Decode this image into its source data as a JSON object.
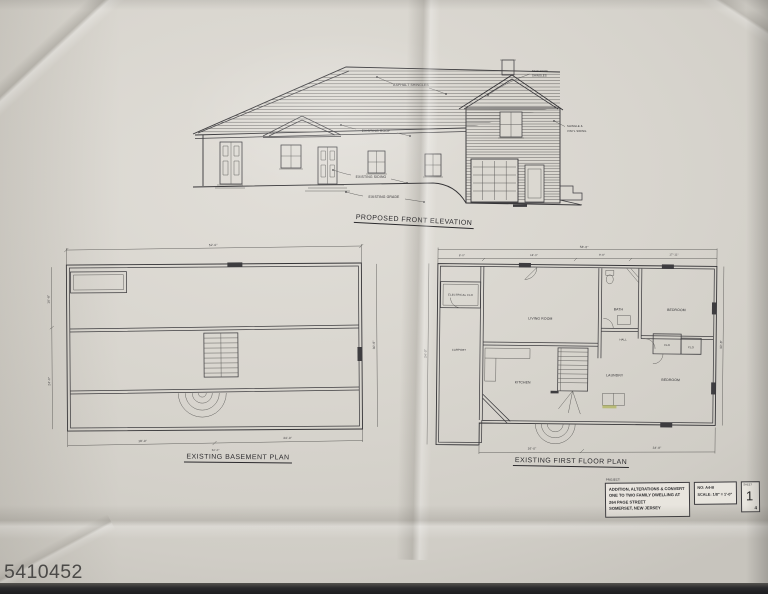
{
  "photo": {
    "watermark": "5410452"
  },
  "elevation": {
    "title": "PROPOSED FRONT ELEVATION",
    "labels": {
      "asphalt": "ASPHALT SHINGLES",
      "existing_roof": "EXISTING ROOF",
      "new_roof_1": "NEW ROOF",
      "new_roof_2": "SHINGLES",
      "siding_right_1": "SHINGLE &",
      "siding_right_2": "VINYL SIDING",
      "existing_siding": "EXISTING SIDING",
      "existing_grade": "EXISTING GRADE"
    }
  },
  "basement": {
    "title": "EXISTING BASEMENT PLAN",
    "dims": {
      "top": "52'-0\"",
      "left_upper": "16'-8\"",
      "left_lower": "24'-0\"",
      "right": "30'-8\"",
      "bottom_left": "18'-0\"",
      "bottom_right": "34'-0\"",
      "bottom_overall": "52'-0\""
    }
  },
  "first_floor": {
    "title": "EXISTING FIRST FLOOR PLAN",
    "rooms": {
      "electrical": "ELECTRICAL CLO",
      "carport": "CARPORT",
      "living": "LIVING ROOM",
      "bath": "BATH",
      "bedroom_top": "BEDROOM",
      "hall": "HALL",
      "clo_a": "CLO",
      "clo_b": "CLO",
      "kitchen": "KITCHEN",
      "laundry": "LAUNDRY",
      "bedroom_bottom": "BEDROOM"
    },
    "dims": {
      "top_overall": "58'-8\"",
      "top_1": "8'-0\"",
      "top_2": "18'-0\"",
      "top_3": "9'-8\"",
      "top_4": "17'-11\"",
      "left": "24'-0\"",
      "right": "30'-8\"",
      "bottom_left": "16'-0\"",
      "bottom_right": "34'-8\""
    }
  },
  "title_block": {
    "project_label": "PROJECT:",
    "line1": "ADDITION, ALTERATIONS & CONVERT",
    "line2": "ONE TO TWO FAMILY DWELLING AT",
    "line3": "264 PAGE STREET",
    "line4": "SOMERSET, NEW JERSEY",
    "job_no": "NO: A4-B",
    "scale": "SCALE: 1/8\" = 1'-0\"",
    "sheet_label": "SHEET",
    "sheet_number": "1",
    "sheet_of": "4"
  }
}
